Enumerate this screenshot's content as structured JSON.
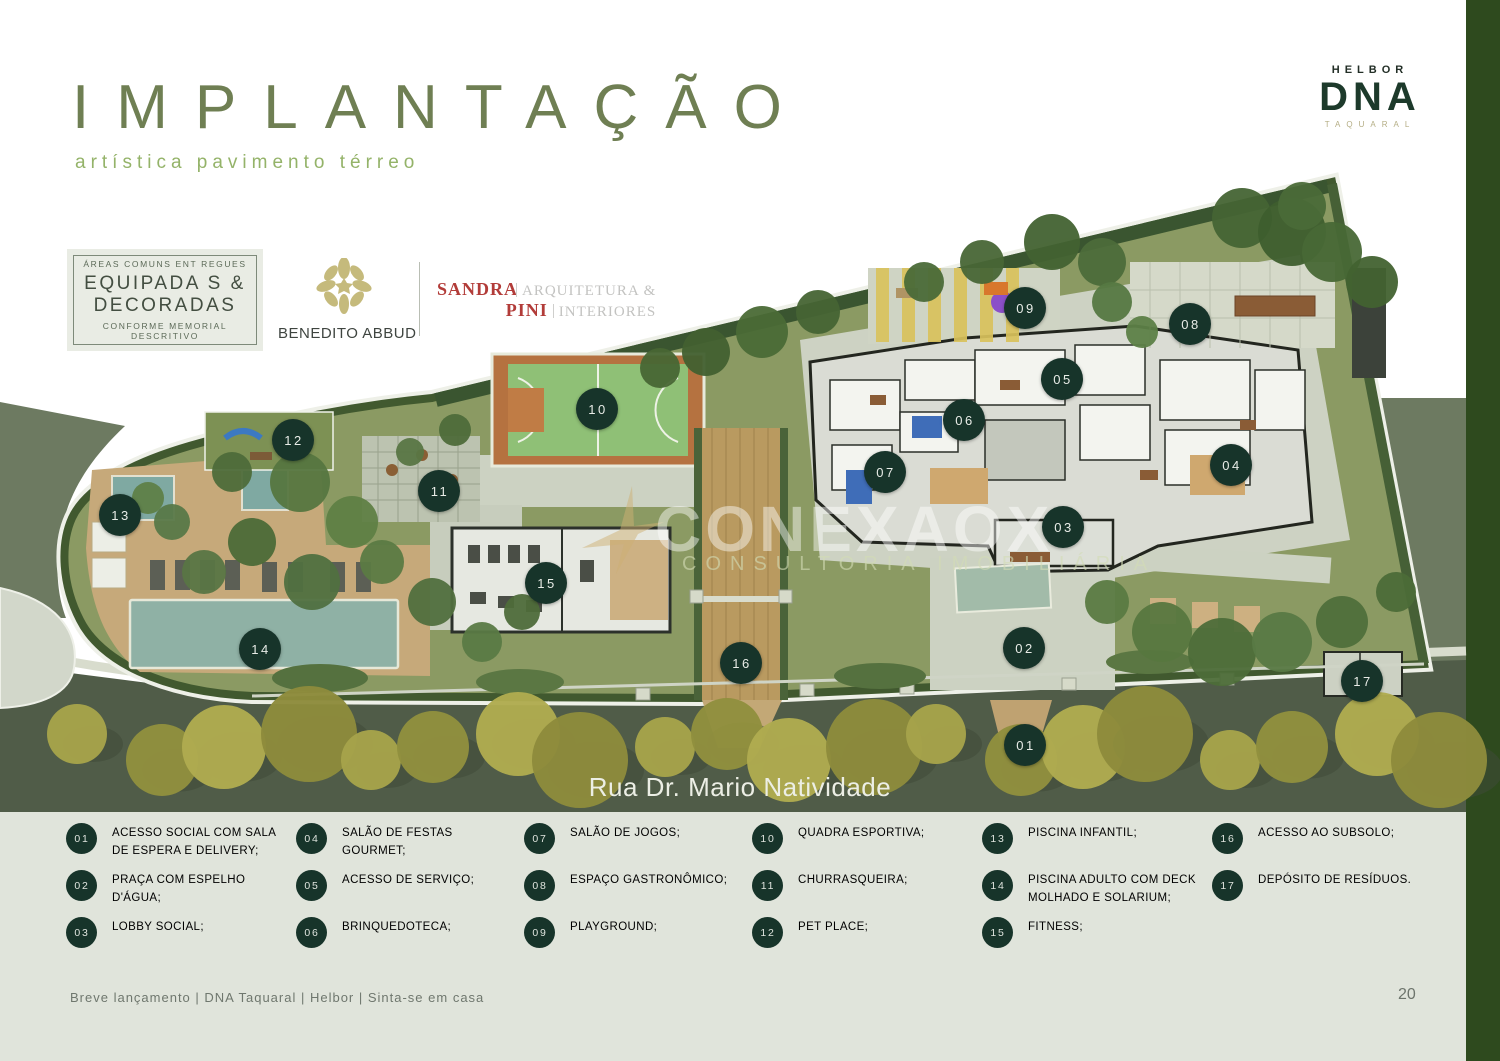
{
  "page": {
    "page_number": "20",
    "footer_text": "Breve lançamento | DNA Taquaral | Helbor | Sinta-se em casa"
  },
  "header": {
    "title": "IMPLANTAÇÃO",
    "subtitle": "artística pavimento térreo"
  },
  "brand": {
    "company": "HELBOR",
    "logo": "DNA",
    "location": "TAQUARAL"
  },
  "badge": {
    "top": "ÁREAS COMUNS ENT REGUES",
    "main_line1": "EQUIPADA S &",
    "main_line2": "DECORADAS",
    "bottom": "CONFORME MEMORIAL DESCRITIVO"
  },
  "partners": {
    "landscape_architect": "BENEDITO ABBUD",
    "interior_line1_name": "SANDRA",
    "interior_line1_desc": "ARQUITETURA &",
    "interior_line2_name": "PINI",
    "interior_line2_desc": "INTERIORES"
  },
  "watermark": {
    "name": "CONEXAOX",
    "tagline": "CONSULTORIA IMOBILIÁRIA"
  },
  "plan": {
    "street_label": "Rua Dr. Mario Natividade",
    "markers": [
      {
        "num": "01",
        "x": 1025,
        "y": 745
      },
      {
        "num": "02",
        "x": 1024,
        "y": 648
      },
      {
        "num": "03",
        "x": 1063,
        "y": 527
      },
      {
        "num": "04",
        "x": 1231,
        "y": 465
      },
      {
        "num": "05",
        "x": 1062,
        "y": 379
      },
      {
        "num": "06",
        "x": 964,
        "y": 420
      },
      {
        "num": "07",
        "x": 885,
        "y": 472
      },
      {
        "num": "08",
        "x": 1190,
        "y": 324
      },
      {
        "num": "09",
        "x": 1025,
        "y": 308
      },
      {
        "num": "10",
        "x": 597,
        "y": 409
      },
      {
        "num": "11",
        "x": 439,
        "y": 491
      },
      {
        "num": "12",
        "x": 293,
        "y": 440
      },
      {
        "num": "13",
        "x": 120,
        "y": 515
      },
      {
        "num": "14",
        "x": 260,
        "y": 649
      },
      {
        "num": "15",
        "x": 546,
        "y": 583
      },
      {
        "num": "16",
        "x": 741,
        "y": 663
      },
      {
        "num": "17",
        "x": 1362,
        "y": 681
      }
    ]
  },
  "legend": {
    "items": [
      {
        "num": "01",
        "label": "ACESSO SOCIAL COM SALA DE ESPERA E DELIVERY;"
      },
      {
        "num": "02",
        "label": "PRAÇA COM ESPELHO D'ÁGUA;"
      },
      {
        "num": "03",
        "label": "LOBBY SOCIAL;"
      },
      {
        "num": "04",
        "label": "SALÃO DE FESTAS GOURMET;"
      },
      {
        "num": "05",
        "label": "ACESSO DE SERVIÇO;"
      },
      {
        "num": "06",
        "label": "BRINQUEDOTECA;"
      },
      {
        "num": "07",
        "label": "SALÃO DE JOGOS;"
      },
      {
        "num": "08",
        "label": "ESPAÇO GASTRONÔMICO;"
      },
      {
        "num": "09",
        "label": "PLAYGROUND;"
      },
      {
        "num": "10",
        "label": "QUADRA ESPORTIVA;"
      },
      {
        "num": "11",
        "label": "CHURRASQUEIRA;"
      },
      {
        "num": "12",
        "label": "PET PLACE;"
      },
      {
        "num": "13",
        "label": "PISCINA INFANTIL;"
      },
      {
        "num": "14",
        "label": "PISCINA ADULTO COM DECK MOLHADO E SOLARIUM;"
      },
      {
        "num": "15",
        "label": "FITNESS;"
      },
      {
        "num": "16",
        "label": "ACESSO AO SUBSOLO;"
      },
      {
        "num": "17",
        "label": "DEPÓSITO DE RESÍDUOS."
      }
    ]
  },
  "colors": {
    "accent_dark_green": "#17342a",
    "title_green": "#6f7f53",
    "subtitle_green": "#94b369",
    "sage_background": "#e0e4db",
    "side_bar_green": "#2e4a1e",
    "street_olive": "#505c48",
    "brand_red": "#b23c39"
  }
}
